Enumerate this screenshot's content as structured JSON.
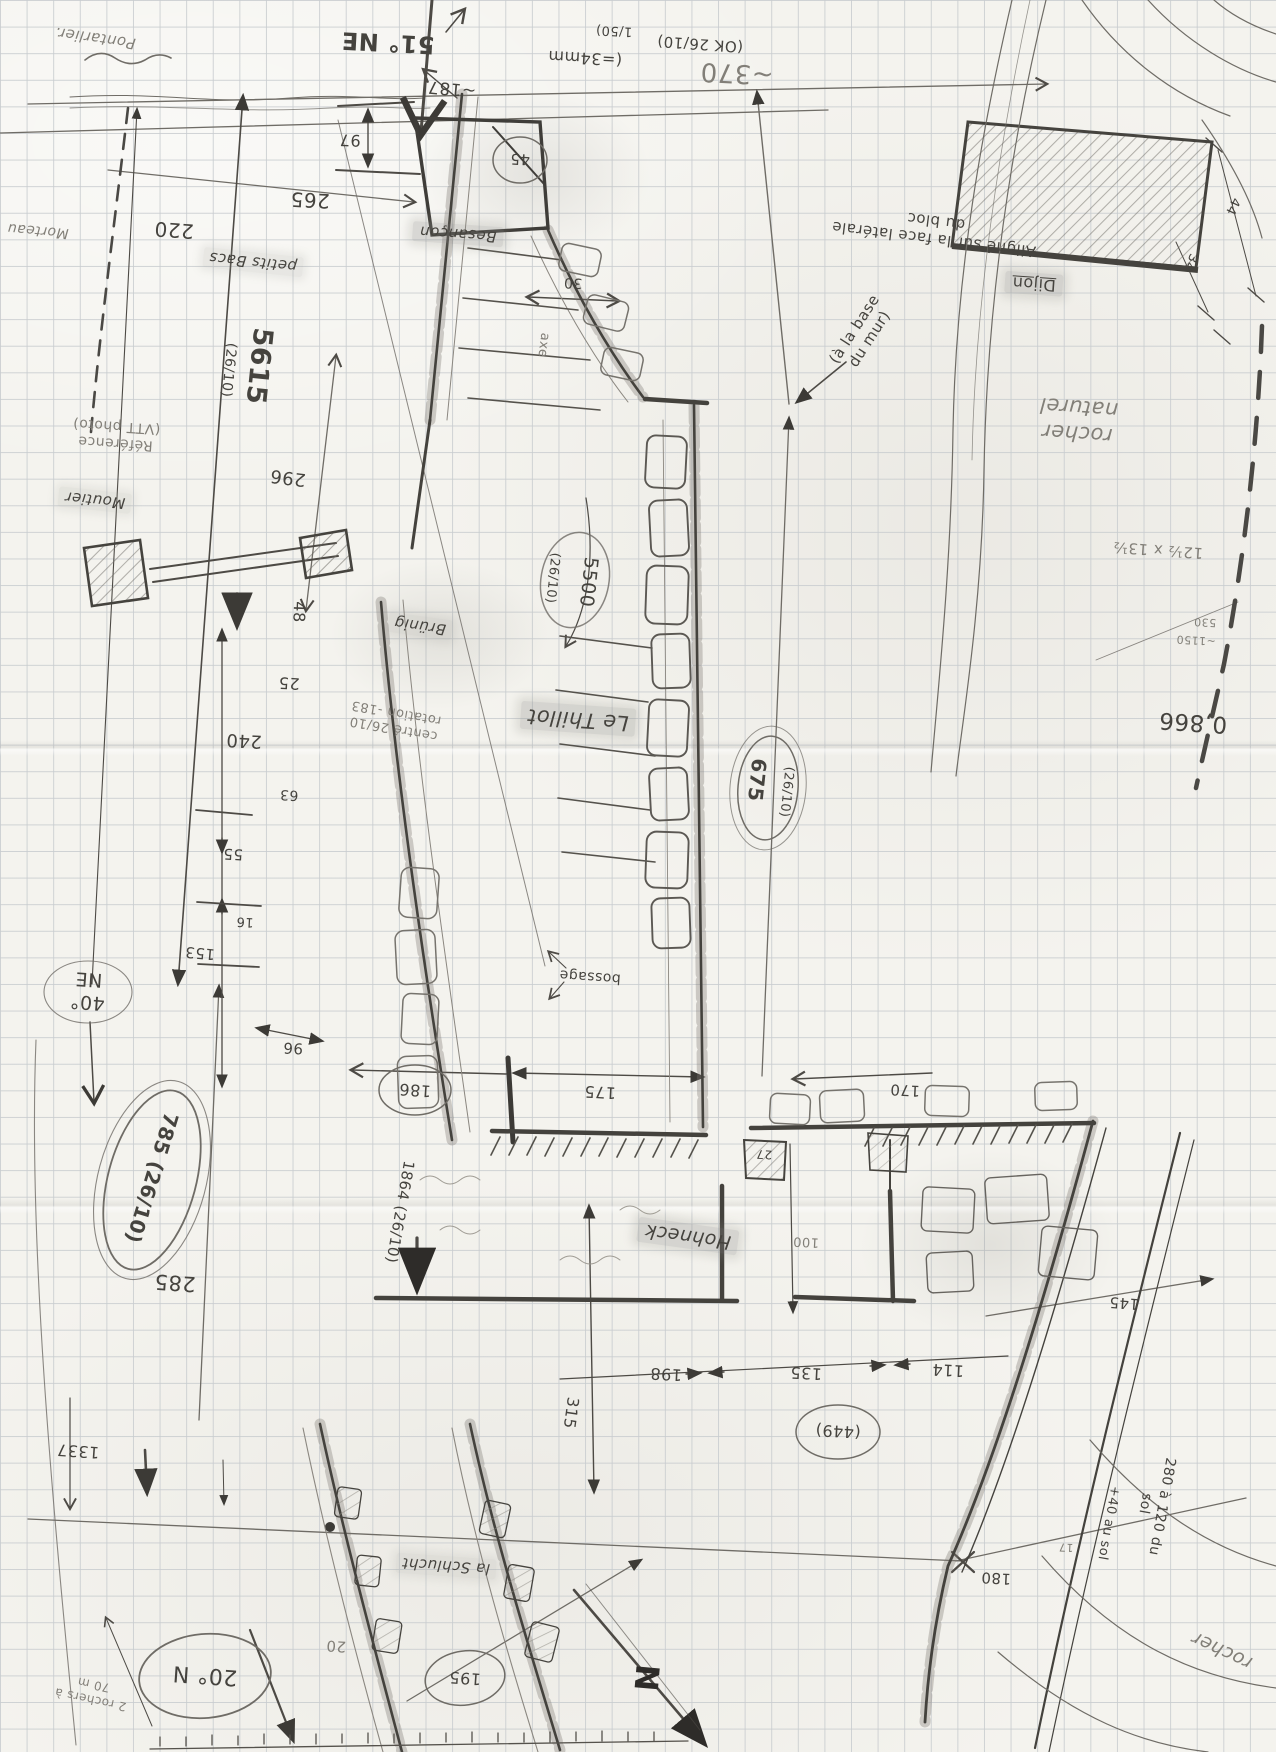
{
  "sheet": {
    "survey_date": "26/10",
    "scale": "1/50",
    "paper_color": "#f4f3ee",
    "grid_color": "#c8ccCF",
    "pencil_color": "#4d4a45"
  },
  "labels": [
    {
      "id": "pontarlier",
      "text": "Pontarlier."
    },
    {
      "id": "bearing-51ne",
      "text": "51° NE"
    },
    {
      "id": "dim-187",
      "text": "~187"
    },
    {
      "id": "dim-97",
      "text": "97"
    },
    {
      "id": "dim-265",
      "text": "265"
    },
    {
      "id": "dim-220",
      "text": "220"
    },
    {
      "id": "morteau",
      "text": "Morteau"
    },
    {
      "id": "scale-34mm",
      "text": "(=34mm"
    },
    {
      "id": "scale-150",
      "text": "1/50)"
    },
    {
      "id": "ok-2610",
      "text": "(OK 26/10)"
    },
    {
      "id": "dim-370",
      "text": "~370"
    },
    {
      "id": "dim-45",
      "text": "45"
    },
    {
      "id": "besancon",
      "text": "Besançon"
    },
    {
      "id": "petits-bacs",
      "text": "petits Bacs"
    },
    {
      "id": "dim-30",
      "text": "30"
    },
    {
      "id": "axe",
      "text": "axe"
    },
    {
      "id": "align-note",
      "text": "Aligné sur la face latérale\ndu bloc"
    },
    {
      "id": "dijon",
      "text": "Dijon"
    },
    {
      "id": "dim-44",
      "text": "44"
    },
    {
      "id": "dim-34",
      "text": "34"
    },
    {
      "id": "rocher-naturel",
      "text": "rocher\nnaturel"
    },
    {
      "id": "dim-bloc",
      "text": "12½ x 13½"
    },
    {
      "id": "dim-530",
      "text": "530"
    },
    {
      "id": "dim-1150",
      "text": "~1150"
    },
    {
      "id": "alt-0866",
      "text": "0,866"
    },
    {
      "id": "num-5615",
      "text": "5615"
    },
    {
      "id": "date-5615",
      "text": "(26/10)"
    },
    {
      "id": "reference",
      "text": "Référence\n(VTT photo)"
    },
    {
      "id": "moutier",
      "text": "Moutier"
    },
    {
      "id": "dim-296",
      "text": "296"
    },
    {
      "id": "dim-48",
      "text": "48"
    },
    {
      "id": "brunig",
      "text": "Brünig"
    },
    {
      "id": "dim-25",
      "text": "25"
    },
    {
      "id": "note-centre",
      "text": "centré 26/10\nrotation -183"
    },
    {
      "id": "dim-240",
      "text": "240"
    },
    {
      "id": "dim-63",
      "text": "63"
    },
    {
      "id": "dim-55",
      "text": "55"
    },
    {
      "id": "dim-16",
      "text": "16"
    },
    {
      "id": "dim-153",
      "text": "153"
    },
    {
      "id": "num-5500",
      "text": "5500"
    },
    {
      "id": "date-5500",
      "text": "(26/10)"
    },
    {
      "id": "le-thillot",
      "text": "Le Thillot"
    },
    {
      "id": "base-mur",
      "text": "(à la base\ndu mur)"
    },
    {
      "id": "num-675",
      "text": "675"
    },
    {
      "id": "date-675",
      "text": "(26/10)"
    },
    {
      "id": "bearing-40ne",
      "text": "40°\nNE"
    },
    {
      "id": "dim-96",
      "text": "96"
    },
    {
      "id": "num-785",
      "text": "785 (26/10)"
    },
    {
      "id": "dim-285",
      "text": "285"
    },
    {
      "id": "bossage",
      "text": "bossage"
    },
    {
      "id": "dim-186",
      "text": "186"
    },
    {
      "id": "dim-175",
      "text": "175"
    },
    {
      "id": "num-1864",
      "text": "1864 (26/10)"
    },
    {
      "id": "hohneck",
      "text": "Hohneck"
    },
    {
      "id": "dim-170",
      "text": "170"
    },
    {
      "id": "dim-27",
      "text": "27"
    },
    {
      "id": "dim-100",
      "text": "100"
    },
    {
      "id": "dim-198",
      "text": "198"
    },
    {
      "id": "dim-135",
      "text": "135"
    },
    {
      "id": "dim-114",
      "text": "114"
    },
    {
      "id": "dim-449",
      "text": "(449)"
    },
    {
      "id": "dim-315",
      "text": "315"
    },
    {
      "id": "dim-145",
      "text": "145"
    },
    {
      "id": "note-280",
      "text": "280 à 120 du sol"
    },
    {
      "id": "note-40sol",
      "text": "+40 au sol"
    },
    {
      "id": "dim-180",
      "text": "180"
    },
    {
      "id": "dim-17",
      "text": "17"
    },
    {
      "id": "rocher",
      "text": "rocher"
    },
    {
      "id": "dim-1337",
      "text": "1337"
    },
    {
      "id": "bearing-20n",
      "text": "20° N"
    },
    {
      "id": "note-rochers",
      "text": "2 rochers à 70 m"
    },
    {
      "id": "dim-20",
      "text": "20"
    },
    {
      "id": "la-schlucht",
      "text": "la Schlucht"
    },
    {
      "id": "dim-195",
      "text": "195"
    },
    {
      "id": "north",
      "text": "N"
    }
  ]
}
